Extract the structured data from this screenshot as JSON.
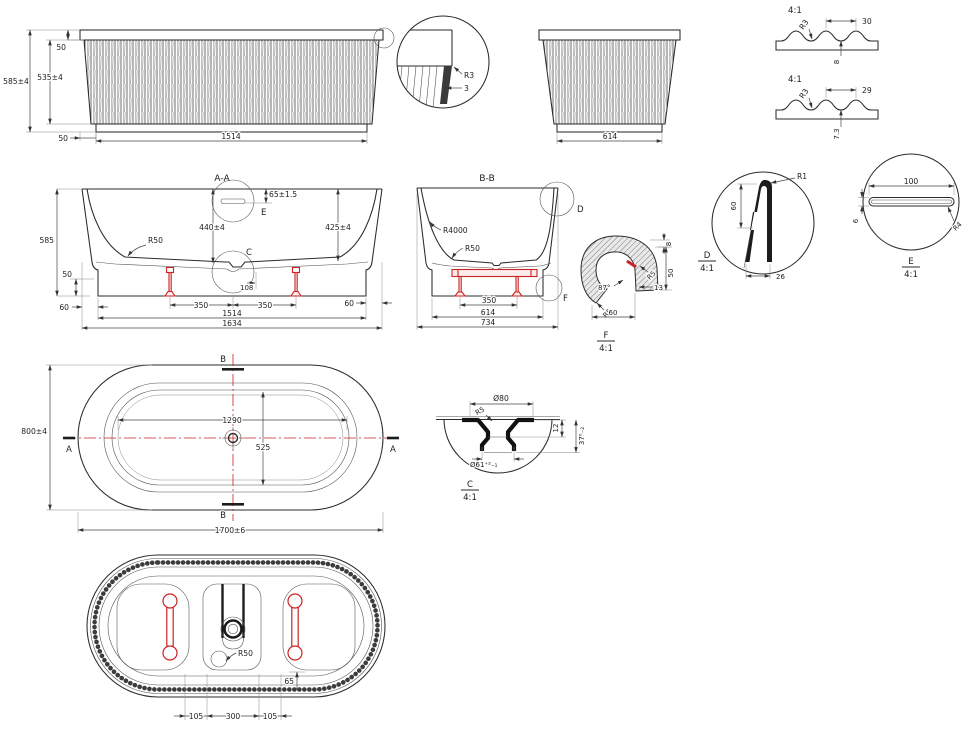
{
  "colors": {
    "ink": "#2b2b2b",
    "accent": "#cc2222"
  },
  "front_view": {
    "dim_height_overall": "585±4",
    "dim_height_body": "535±4",
    "dim_rim_height": "50",
    "dim_base_inset": "50",
    "dim_width_base": "1514"
  },
  "rim_detail": {
    "radius": "R3",
    "thickness": "3"
  },
  "side_view": {
    "dim_width_base": "614"
  },
  "flute_profile_front": {
    "scale": "4:1",
    "radius": "R3",
    "pitch": "30",
    "depth": "8"
  },
  "flute_profile_side": {
    "scale": "4:1",
    "radius": "R3",
    "pitch": "29",
    "depth": "7.3"
  },
  "section_aa": {
    "title": "A-A",
    "dim_overflow_drop": "65±1.5",
    "detail_e_label": "E",
    "dim_depth_center": "440±4",
    "dim_depth_wall": "425±4",
    "radius_floor": "R50",
    "detail_c_label": "C",
    "dim_height": "585",
    "dim_skirt": "50",
    "dim_inset_left": "60",
    "dim_inset_right": "60",
    "dim_foot_left": "350",
    "dim_foot_right": "350",
    "dim_drain_offset": "108",
    "dim_width_base": "1514",
    "dim_width_overall": "1634"
  },
  "section_bb": {
    "title": "B-B",
    "radius_wall": "R4000",
    "radius_floor": "R50",
    "detail_d_label": "D",
    "detail_f_label": "F",
    "dim_feet": "350",
    "dim_width_base": "614",
    "dim_width_overall": "734"
  },
  "detail_d": {
    "label": "D",
    "scale": "4:1",
    "radius_tip": "R1",
    "dim_height": "60",
    "dim_width": "26"
  },
  "detail_e": {
    "label": "E",
    "scale": "4:1",
    "dim_length": "100",
    "dim_height": "6",
    "radius_corner": "R4"
  },
  "detail_f": {
    "label": "F",
    "scale": "4:1",
    "dim_rim": "8",
    "radius_upper": "R5",
    "angle": "87°",
    "dim_offset": "13",
    "dim_height": "50",
    "radius_lower": "R5",
    "dim_width": "60"
  },
  "plan_view": {
    "dim_width": "800±4",
    "dim_length": "1700±6",
    "dim_inner_length": "1290",
    "dim_inner_width": "525",
    "section_a_left": "A",
    "section_a_right": "A",
    "section_b_top": "B",
    "section_b_bottom": "B"
  },
  "detail_c": {
    "label": "C",
    "scale": "4:1",
    "dim_outer": "Ø80",
    "radius": "R5",
    "dim_step": "12",
    "dim_depth": "37⁰₋₂",
    "dim_inner": "Ø61⁺²₋₁"
  },
  "bottom_view": {
    "radius_channel": "R50",
    "dim_edge": "65",
    "dim_left": "105",
    "dim_center": "300",
    "dim_right": "105"
  }
}
